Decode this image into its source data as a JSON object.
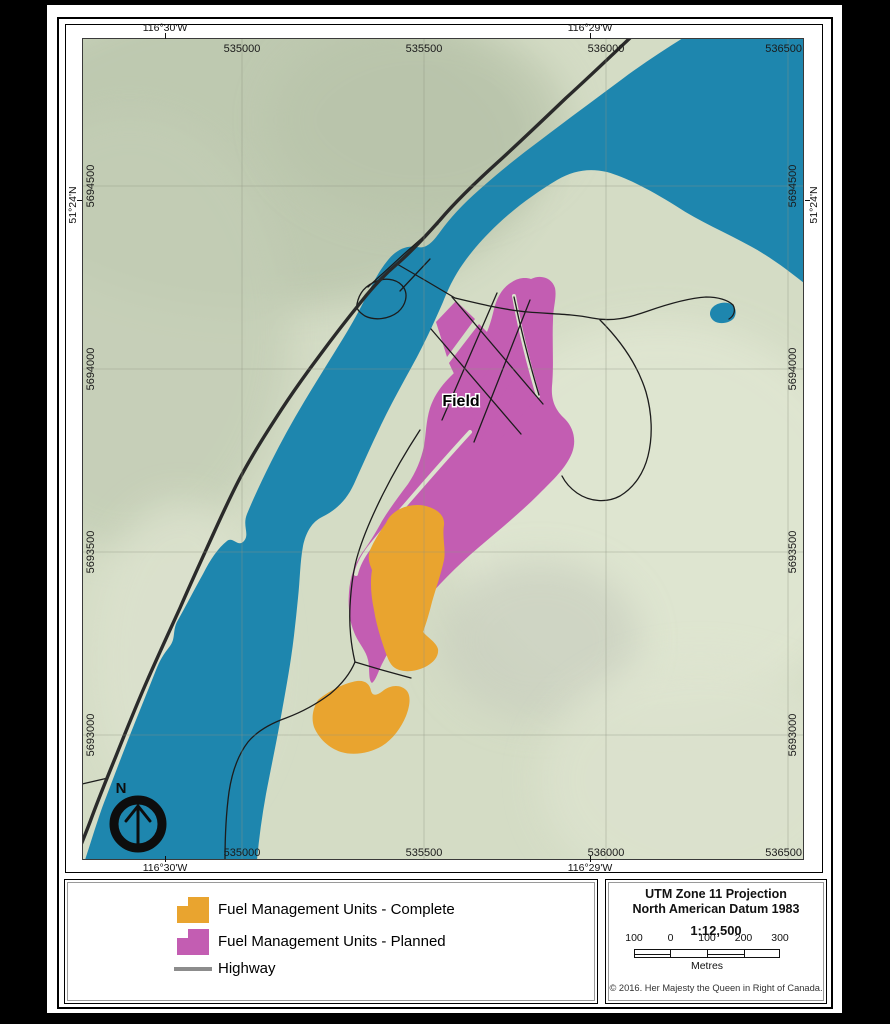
{
  "map": {
    "place_label": "Field",
    "north_label": "N",
    "top_lon_labels": [
      "116°30'W",
      "116°29'W"
    ],
    "bottom_lon_labels": [
      "116°30'W",
      "116°29'W"
    ],
    "lat_label_left": "51°24'N",
    "lat_label_right": "51°24'N",
    "grid_top_labels": [
      "535000",
      "535500",
      "536000",
      "536500"
    ],
    "grid_bottom_labels": [
      "535000",
      "535500",
      "536000",
      "536500"
    ],
    "grid_left_labels": [
      "5694500",
      "5694000",
      "5693500",
      "5693000"
    ],
    "grid_right_labels": [
      "5694500",
      "5694000",
      "5693500",
      "5693000"
    ]
  },
  "legend": {
    "items": [
      {
        "label": "Fuel Management Units - Complete",
        "color": "#E9A42F",
        "type": "polygon"
      },
      {
        "label": "Fuel Management Units - Planned",
        "color": "#C35DB2",
        "type": "polygon"
      },
      {
        "label": "Highway",
        "color": "#8C8C8C",
        "type": "line"
      }
    ]
  },
  "info": {
    "projection_line1": "UTM Zone 11 Projection",
    "projection_line2": "North American Datum 1983",
    "scale_text": "1:12,500",
    "scalebar_labels": [
      "100",
      "0",
      "100",
      "200",
      "300"
    ],
    "units_label": "Metres",
    "copyright": "© 2016. Her Majesty the Queen in Right of Canada."
  },
  "colors": {
    "water": "#1E86AE",
    "fmu_complete": "#E9A42F",
    "fmu_planned": "#C35DB2",
    "terrain_base": "#D4DCC5",
    "highway": "#2A2A2A",
    "road": "#1C1C1C"
  }
}
